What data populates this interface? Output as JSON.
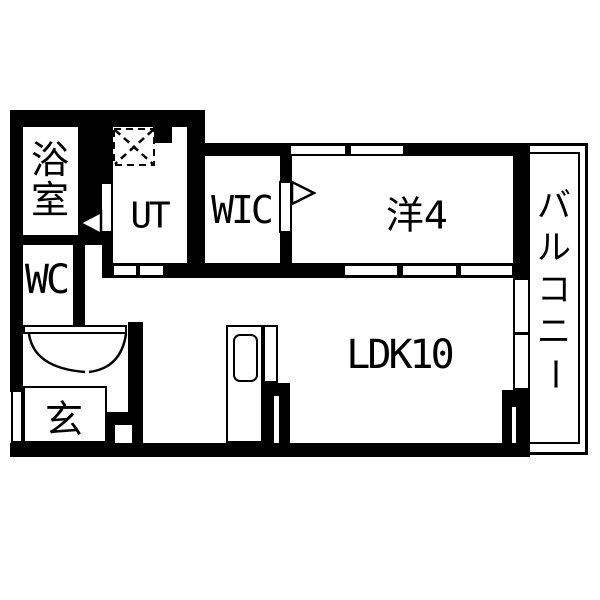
{
  "title": "apartment-floor-plan",
  "colors": {
    "wall": "#000000",
    "background": "#ffffff"
  },
  "rooms": {
    "bathroom": {
      "label": "浴室"
    },
    "utility": {
      "label": "UT"
    },
    "walk_in_closet": {
      "label": "WIC"
    },
    "western_room": {
      "label": "洋4"
    },
    "balcony": {
      "label": "バルコニー"
    },
    "toilet": {
      "label": "WC"
    },
    "entrance": {
      "label": "玄"
    },
    "living_dining_kitchen": {
      "label": "LDK10"
    }
  },
  "fixtures": {
    "washer_area": "dashed-hatch-square",
    "kitchen_sink": "rounded-rect-sink",
    "bathroom_door": "triangle-left",
    "wic_door": "triangle-right",
    "entrance_closet_doors": "double-swing-arcs"
  }
}
